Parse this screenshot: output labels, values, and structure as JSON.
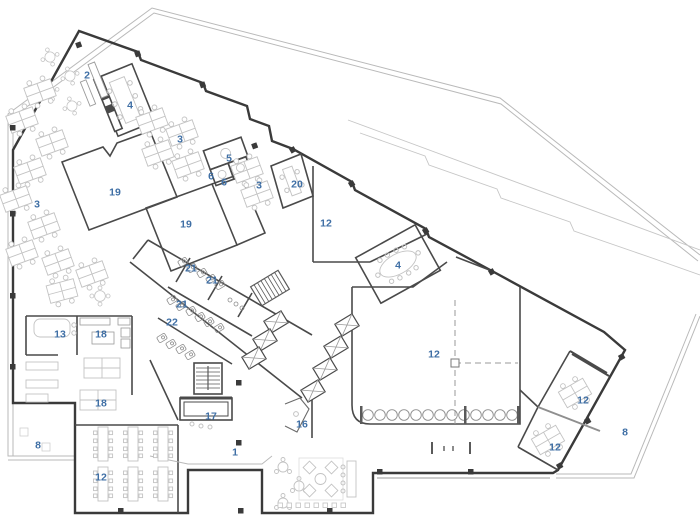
{
  "plan": {
    "colors": {
      "room_label": "#3f6fa5",
      "walls": "#3a3a3a",
      "interior_walls": "#4a4a4a",
      "furniture": "#c3c3c3",
      "site_boundary": "#b9b9b9"
    },
    "room_labels": [
      {
        "text": "2",
        "x": 87,
        "y": 75
      },
      {
        "text": "4",
        "x": 130,
        "y": 105
      },
      {
        "text": "3",
        "x": 180,
        "y": 139
      },
      {
        "text": "5",
        "x": 229,
        "y": 158
      },
      {
        "text": "6",
        "x": 211,
        "y": 176
      },
      {
        "text": "6",
        "x": 224,
        "y": 182
      },
      {
        "text": "3",
        "x": 259,
        "y": 185
      },
      {
        "text": "20",
        "x": 297,
        "y": 184
      },
      {
        "text": "19",
        "x": 115,
        "y": 192
      },
      {
        "text": "19",
        "x": 186,
        "y": 224
      },
      {
        "text": "12",
        "x": 326,
        "y": 223
      },
      {
        "text": "3",
        "x": 37,
        "y": 204
      },
      {
        "text": "21",
        "x": 191,
        "y": 268
      },
      {
        "text": "21",
        "x": 212,
        "y": 280
      },
      {
        "text": "21",
        "x": 182,
        "y": 304
      },
      {
        "text": "22",
        "x": 172,
        "y": 322
      },
      {
        "text": "4",
        "x": 398,
        "y": 265
      },
      {
        "text": "13",
        "x": 60,
        "y": 334
      },
      {
        "text": "18",
        "x": 101,
        "y": 334
      },
      {
        "text": "18",
        "x": 101,
        "y": 403
      },
      {
        "text": "17",
        "x": 211,
        "y": 416
      },
      {
        "text": "16",
        "x": 302,
        "y": 424
      },
      {
        "text": "12",
        "x": 434,
        "y": 354
      },
      {
        "text": "8",
        "x": 38,
        "y": 445
      },
      {
        "text": "1",
        "x": 235,
        "y": 452
      },
      {
        "text": "12",
        "x": 101,
        "y": 477
      },
      {
        "text": "12",
        "x": 583,
        "y": 400
      },
      {
        "text": "12",
        "x": 555,
        "y": 447
      },
      {
        "text": "8",
        "x": 625,
        "y": 432
      }
    ]
  }
}
